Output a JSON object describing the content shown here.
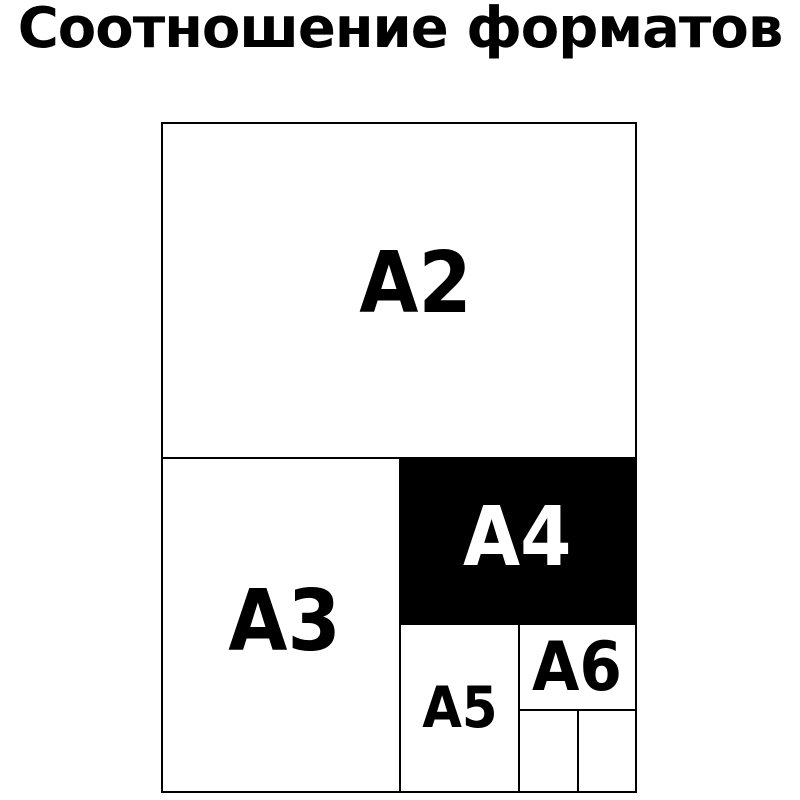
{
  "title": "Соотношение форматов",
  "colors": {
    "background": "#ffffff",
    "line": "#000000",
    "title_text": "#000000",
    "a4_fill": "#000000",
    "a4_text": "#ffffff",
    "label_text": "#000000"
  },
  "diagram": {
    "description_type": "paper-format-size-comparison",
    "formats": [
      {
        "id": "a2",
        "label": "A2",
        "fill": "#ffffff",
        "text_color": "#000000"
      },
      {
        "id": "a3",
        "label": "A3",
        "fill": "#ffffff",
        "text_color": "#000000"
      },
      {
        "id": "a4",
        "label": "A4",
        "fill": "#000000",
        "text_color": "#ffffff"
      },
      {
        "id": "a5",
        "label": "A5",
        "fill": "#ffffff",
        "text_color": "#000000"
      },
      {
        "id": "a6",
        "label": "A6",
        "fill": "#ffffff",
        "text_color": "#000000"
      },
      {
        "id": "a7",
        "label": "",
        "fill": "#ffffff"
      },
      {
        "id": "a8",
        "label": "",
        "fill": "#ffffff"
      }
    ]
  }
}
